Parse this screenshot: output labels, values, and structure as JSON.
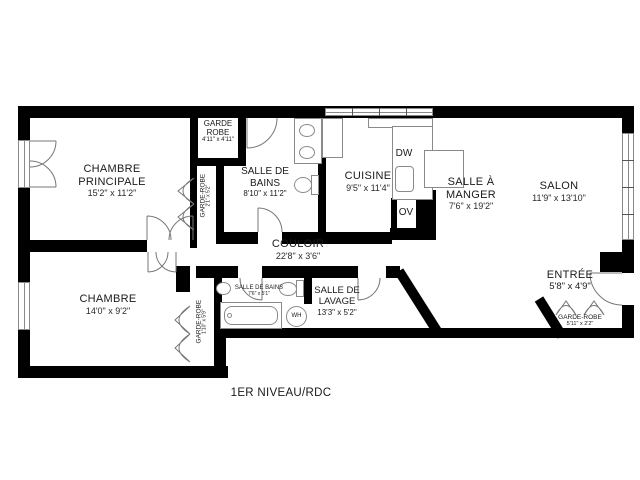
{
  "floor_label": "1ER NIVEAU/RDC",
  "rooms": {
    "chambre_principale": {
      "line1": "CHAMBRE",
      "line2": "PRINCIPALE",
      "dims": "15'2\" x 11'2\""
    },
    "garde_robe_haut": {
      "line1": "GARDE",
      "line2": "ROBE",
      "dims": "4'11\" x 4'11\""
    },
    "garde_robe_cp": {
      "name": "GARDE-ROBE",
      "dims": "2'1\" x 5'2\""
    },
    "salle_de_bains": {
      "line1": "SALLE DE",
      "line2": "BAINS",
      "dims": "8'10\" x 11'2\""
    },
    "cuisine": {
      "name": "CUISINE",
      "dims": "9'5\" x 11'4\""
    },
    "salle_a_manger": {
      "line1": "SALLE À",
      "line2": "MANGER",
      "dims": "7'6\" x 19'2\""
    },
    "salon": {
      "name": "SALON",
      "dims": "11'9\" x 13'10\""
    },
    "couloir": {
      "name": "COULOIR",
      "dims": "22'8\" x 3'6\""
    },
    "chambre": {
      "name": "CHAMBRE",
      "dims": "14'0\" x 9'2\""
    },
    "garde_robe_chambre": {
      "name": "GARDE-ROBE",
      "dims": "1'10\" x 5'9\""
    },
    "salle_de_bains_2": {
      "name": "SALLE DE BAINS",
      "dims": "7'6\" x 5'1\""
    },
    "salle_de_lavage": {
      "line1": "SALLE DE",
      "line2": "LAVAGE",
      "dims": "13'3\" x 5'2\""
    },
    "entree": {
      "name": "ENTRÉE",
      "dims": "5'8\" x 4'9\""
    },
    "garde_robe_entree": {
      "name": "GARDE-ROBE",
      "dims": "5'11\" x 2'2\""
    }
  },
  "appliances": {
    "dishwasher": "DW",
    "oven": "OV",
    "water_heater": "WH"
  },
  "colors": {
    "wall": "#000000",
    "fixture_line": "#8a8a8a",
    "text": "#1a1a1a",
    "background": "#ffffff"
  }
}
